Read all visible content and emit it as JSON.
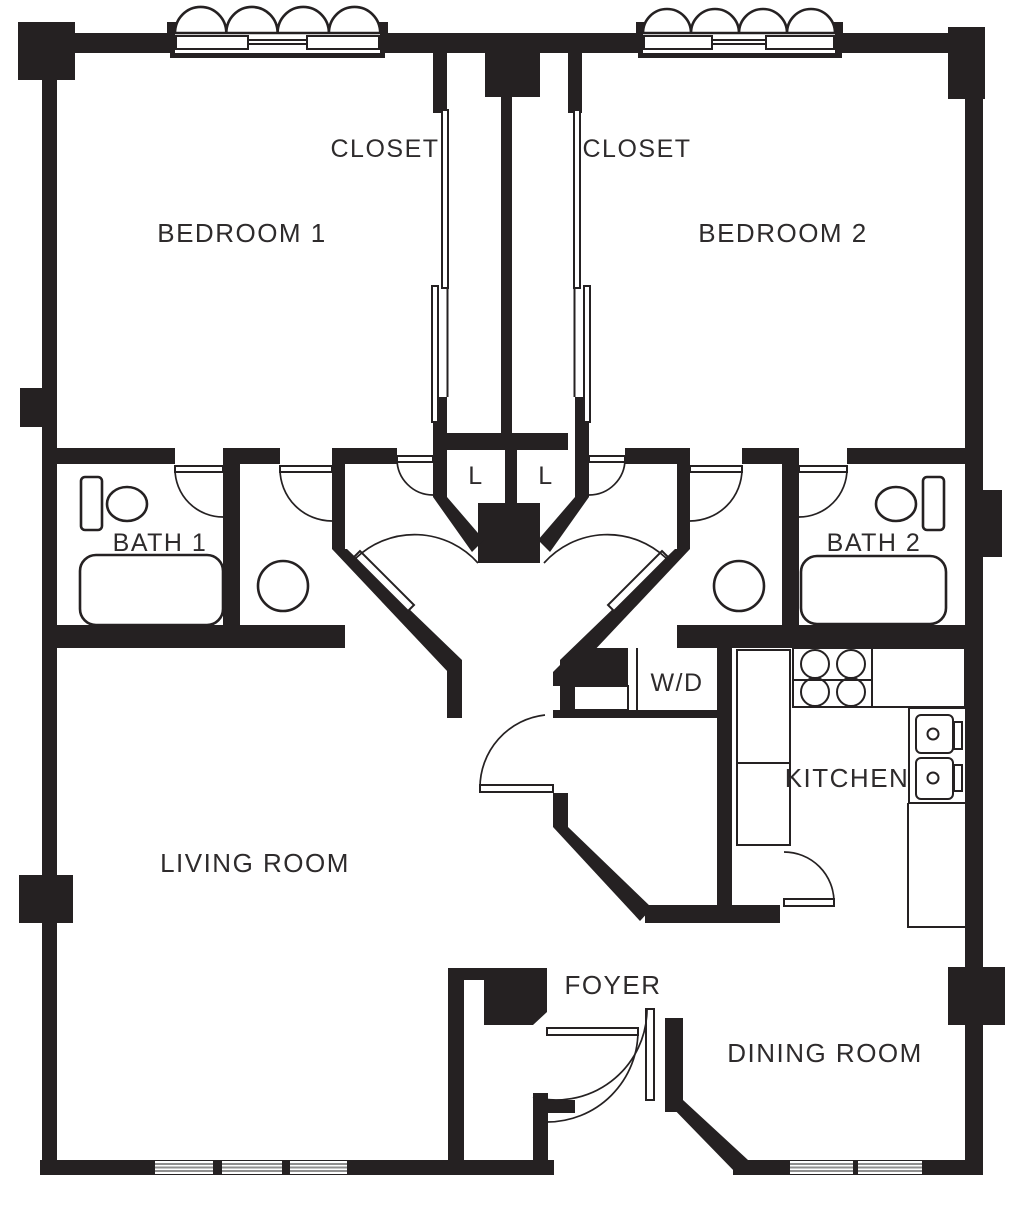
{
  "colors": {
    "wall": "#252122",
    "label_text": "#2e2b2c",
    "background": "#ffffff",
    "window_line": "#8f8f8f"
  },
  "rooms": {
    "bedroom1": {
      "label": "BEDROOM 1"
    },
    "bedroom2": {
      "label": "BEDROOM 2"
    },
    "closet1": {
      "label": "CLOSET"
    },
    "closet2": {
      "label": "CLOSET"
    },
    "linen1": {
      "label": "L"
    },
    "linen2": {
      "label": "L"
    },
    "bath1": {
      "label": "BATH 1"
    },
    "bath2": {
      "label": "BATH 2"
    },
    "washer_dryer": {
      "label": "W/D"
    },
    "kitchen": {
      "label": "KITCHEN"
    },
    "living_room": {
      "label": "LIVING ROOM"
    },
    "foyer": {
      "label": "FOYER"
    },
    "dining_room": {
      "label": "DINING ROOM"
    }
  }
}
